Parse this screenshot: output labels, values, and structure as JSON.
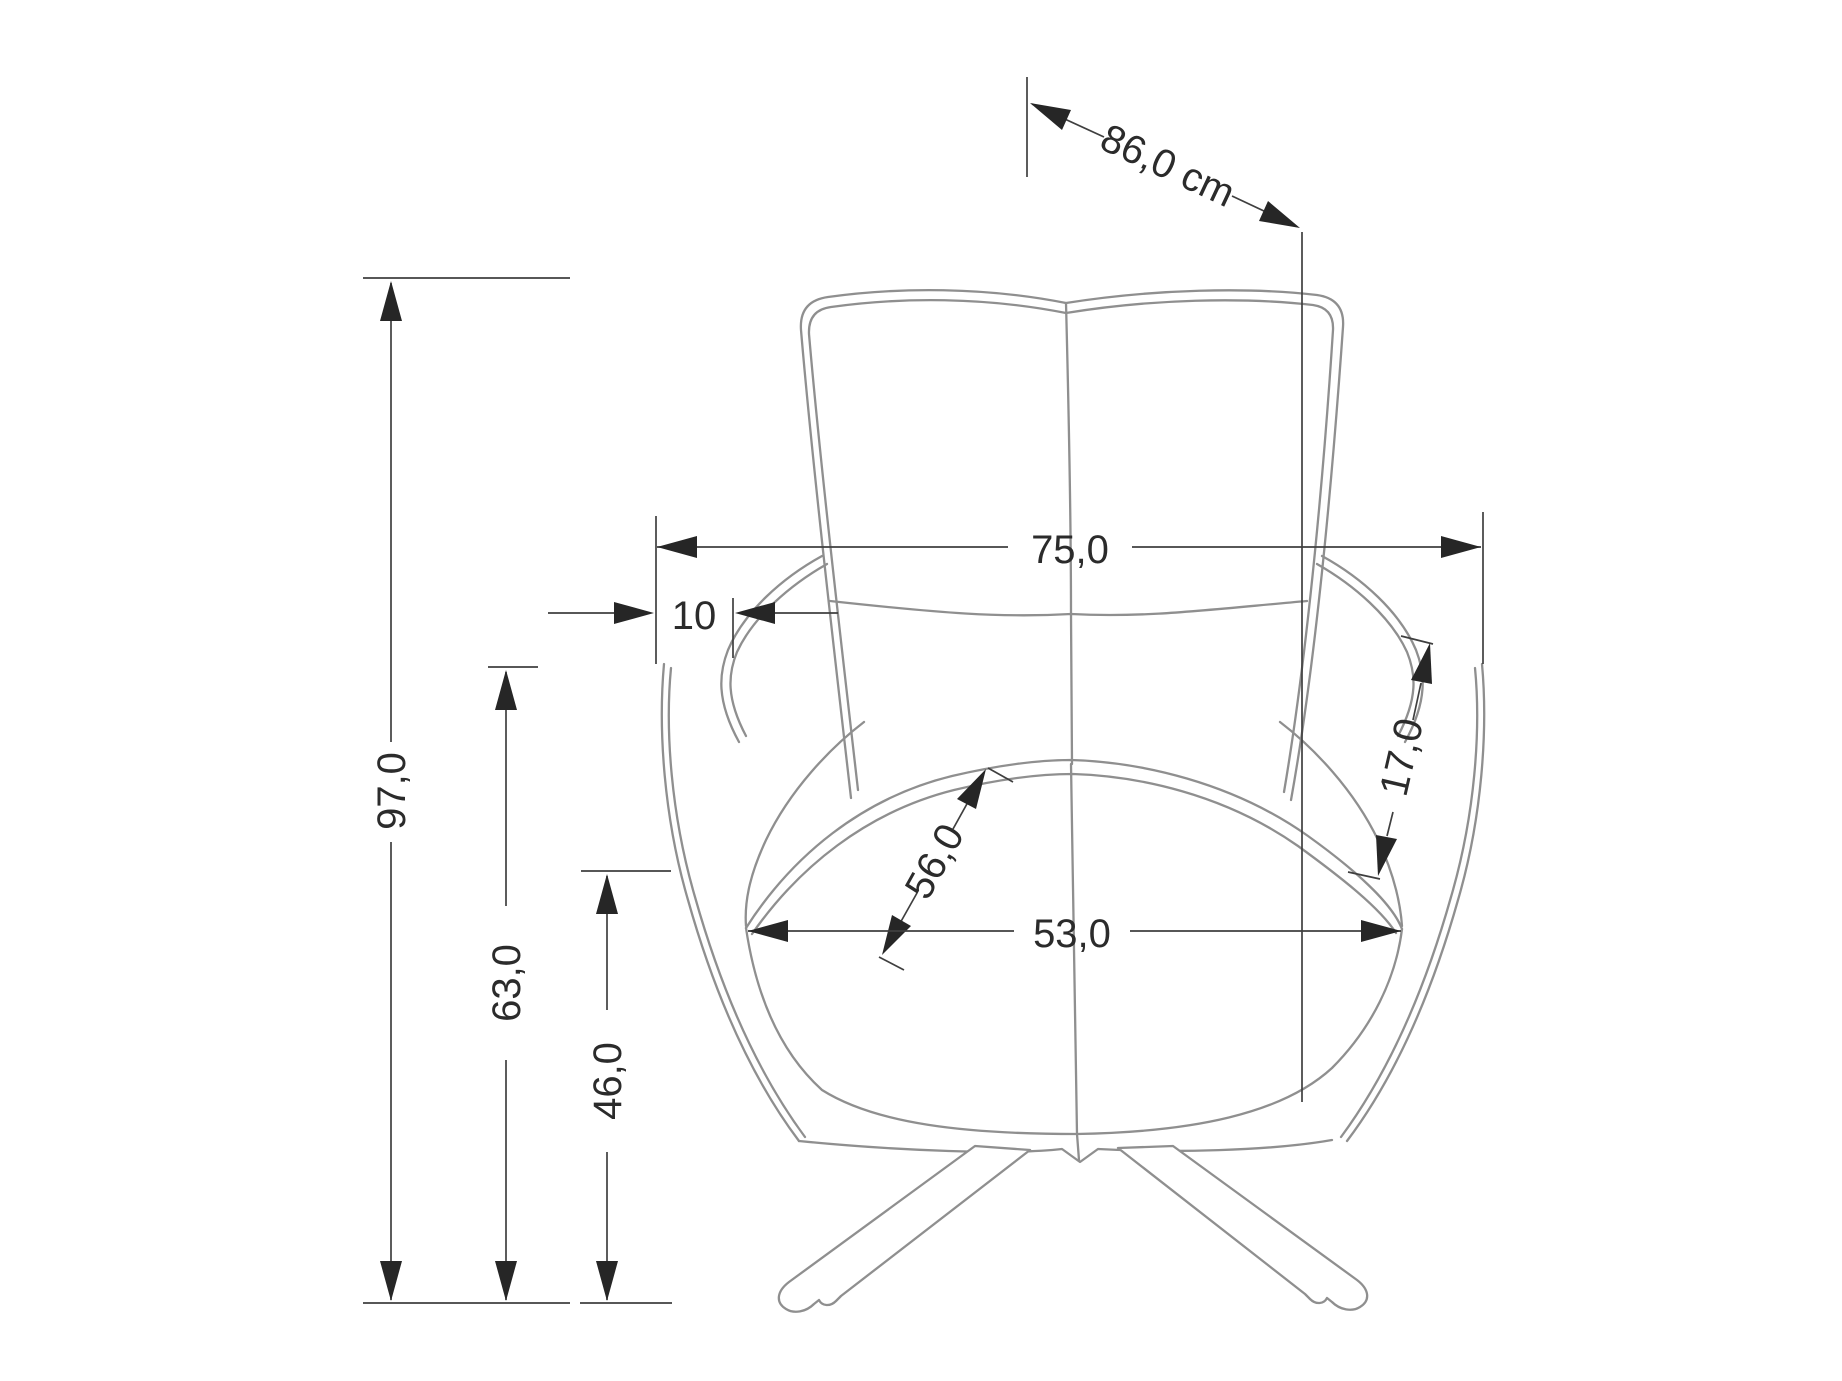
{
  "drawing": {
    "type": "technical-dimension-drawing",
    "subject": "armchair-front-view",
    "unit_suffix_shown_once": "cm",
    "background_color": "#ffffff",
    "chair_line_color": "#8f8f8f",
    "dimension_line_color": "#3f3f3f",
    "arrow_color": "#262626",
    "dimensions": {
      "depth_diagonal": "86,0 cm",
      "overall_width": "75,0",
      "wing_offset": "10",
      "overall_height": "97,0",
      "armrest_height": "63,0",
      "seat_height": "46,0",
      "seat_depth": "56,0",
      "seat_width": "53,0",
      "wing_panel": "17,0"
    }
  }
}
